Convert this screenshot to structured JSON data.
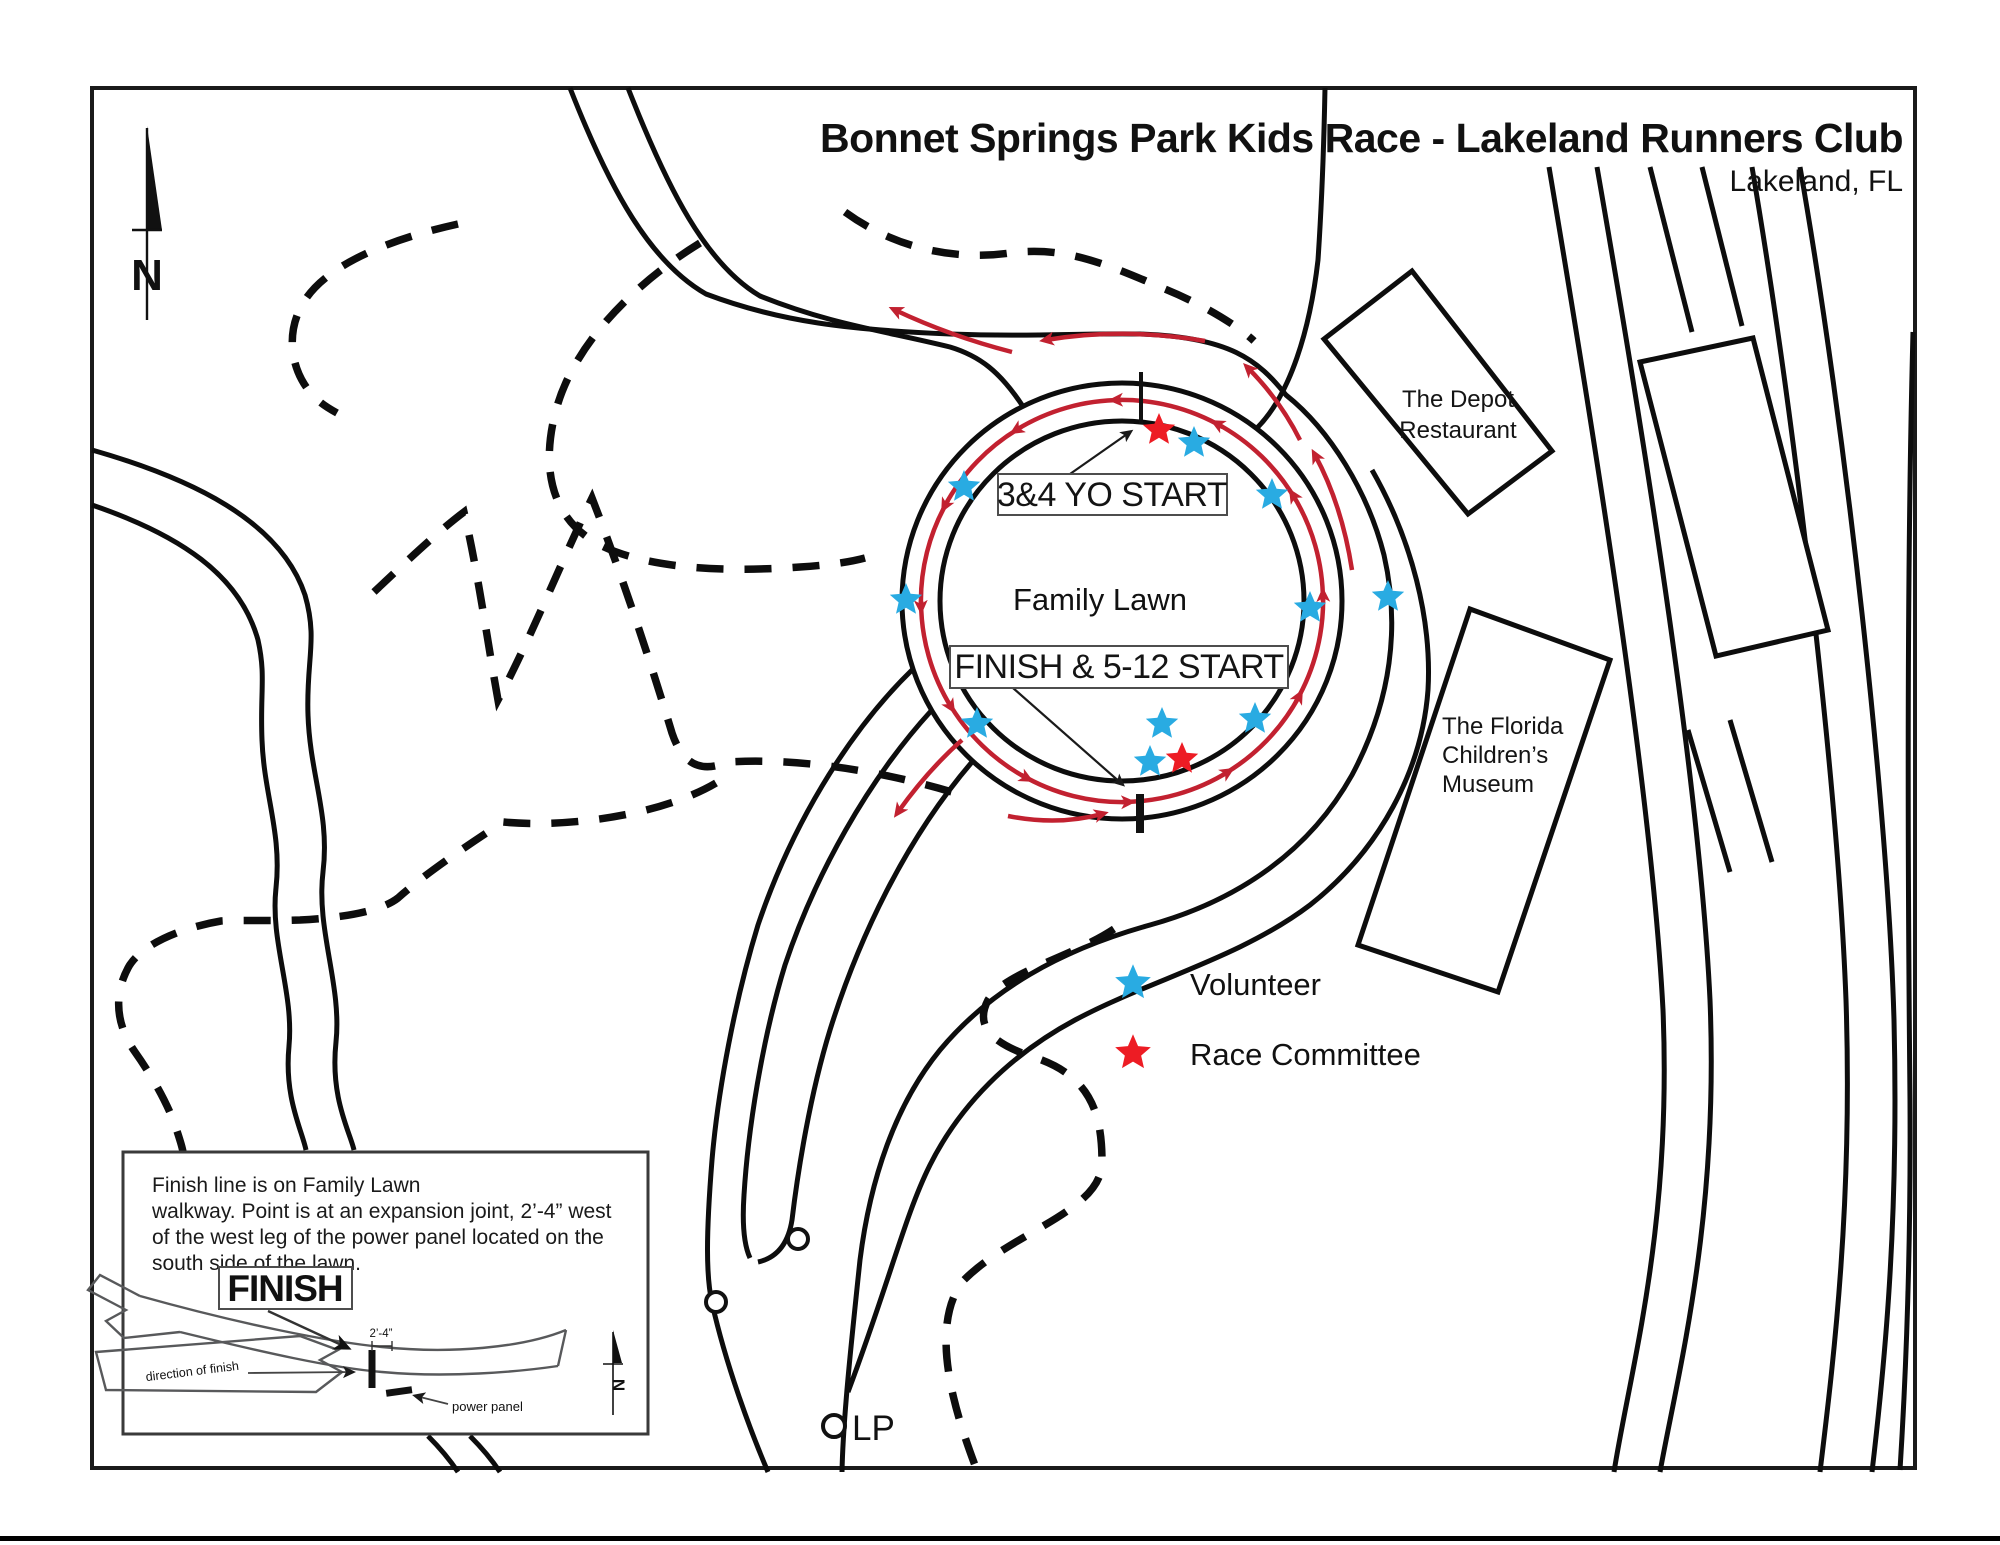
{
  "title": "Bonnet Springs Park Kids Race - Lakeland Runners Club",
  "subtitle": "Lakeland, FL",
  "compass": {
    "north_label": "N"
  },
  "course": {
    "lawn_label": "Family Lawn",
    "start_3_4_label": "3&4 YO START",
    "finish_5_12_label": "FINISH & 5-12 START"
  },
  "buildings": {
    "depot": {
      "line1": "The Depot",
      "line2": "Restaurant"
    },
    "museum": {
      "line1": "The Florida",
      "line2": "Children’s",
      "line3": "Museum"
    }
  },
  "legend": {
    "volunteer": {
      "label": "Volunteer",
      "color": "#29abe2"
    },
    "race_committee": {
      "label": "Race Committee",
      "color": "#ed1c24"
    }
  },
  "map_labels": {
    "light_pole": "LP"
  },
  "inset": {
    "note_line1": "Finish line is on Family Lawn",
    "note_line2": "walkway. Point is at an expansion joint, 2’-4” west",
    "note_line3": "of the west leg of the power panel located on the",
    "note_line4": "south side of the lawn.",
    "finish_label": "FINISH",
    "dimension_label": "2’-4”",
    "direction_label": "direction of finish",
    "power_panel_label": "power panel",
    "north_label": "N"
  },
  "colors": {
    "volunteer_blue": "#29abe2",
    "committee_red": "#ed1c24",
    "arrow_red": "#c22130"
  },
  "stars": [
    {
      "type": "committee",
      "x": 1159,
      "y": 430
    },
    {
      "type": "volunteer",
      "x": 1194,
      "y": 443
    },
    {
      "type": "volunteer",
      "x": 964,
      "y": 487
    },
    {
      "type": "volunteer",
      "x": 1272,
      "y": 495
    },
    {
      "type": "volunteer",
      "x": 906,
      "y": 600
    },
    {
      "type": "volunteer",
      "x": 1310,
      "y": 608
    },
    {
      "type": "volunteer",
      "x": 1388,
      "y": 597
    },
    {
      "type": "volunteer",
      "x": 977,
      "y": 724
    },
    {
      "type": "volunteer",
      "x": 1162,
      "y": 724
    },
    {
      "type": "volunteer",
      "x": 1255,
      "y": 719
    },
    {
      "type": "volunteer",
      "x": 1150,
      "y": 762
    },
    {
      "type": "committee",
      "x": 1182,
      "y": 759
    }
  ]
}
